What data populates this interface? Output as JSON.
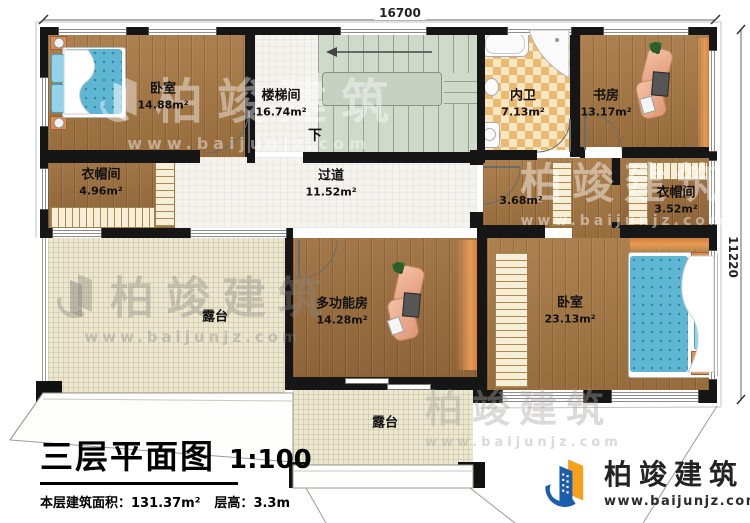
{
  "dimensions": {
    "top": "16700",
    "right": "11220"
  },
  "rooms": {
    "bedroom_tl": {
      "name": "卧室",
      "area": "14.88m²"
    },
    "stairwell": {
      "name": "楼梯间",
      "area": "16.74m²",
      "down_label": "下"
    },
    "bathroom": {
      "name": "内卫",
      "area": "7.13m²"
    },
    "study": {
      "name": "书房",
      "area": "13.17m²"
    },
    "cloakroom_left": {
      "name": "衣帽间",
      "area": "4.96m²"
    },
    "corridor": {
      "name": "过道",
      "area": "11.52m²"
    },
    "hall": {
      "area": "3.68m²"
    },
    "cloakroom_right": {
      "name": "衣帽间",
      "area": "3.52m²"
    },
    "multi_room": {
      "name": "多功能房",
      "area": "14.28m²"
    },
    "bedroom_br": {
      "name": "卧室",
      "area": "23.13m²"
    },
    "terrace_left": {
      "name": "露台"
    },
    "terrace_bottom": {
      "name": "露台"
    }
  },
  "title_block": {
    "title": "三层平面图",
    "scale": "1:100",
    "floor_area_label": "本层建筑面积：",
    "floor_area_value": "131.37m²",
    "floor_height_label": "层高：",
    "floor_height_value": "3.3m"
  },
  "branding": {
    "company": "柏竣建筑",
    "website": "www.baijunjz.com"
  },
  "watermark": {
    "company": "柏竣建筑",
    "website": "www.baijunjz.com"
  },
  "colors": {
    "wall": "#161616",
    "wood": "#a87944",
    "stair": "#cfdacb",
    "terrace": "#ebe7d0",
    "tile_orange": "#e9b96e",
    "mattress": "#5fb6d2",
    "accent_orange": "#e89a55",
    "logo_blue": "#1a5dab",
    "logo_orange": "#f6a01e"
  }
}
